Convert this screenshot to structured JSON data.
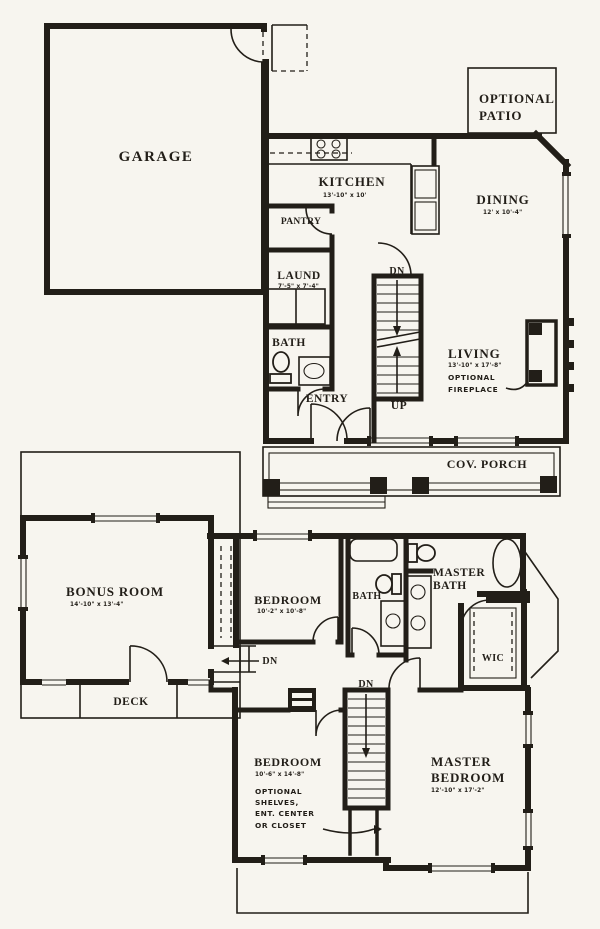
{
  "title": "Two-story house floor plan",
  "colors": {
    "paper": "#f7f5ef",
    "ink": "#221e18"
  },
  "first_floor": {
    "garage": "GARAGE",
    "kitchen": {
      "name": "KITCHEN",
      "dims": "13'-10\" x 10'"
    },
    "pantry": "PANTRY",
    "laundry": {
      "name": "LAUND",
      "dims": "7'-5\" x 7'-4\""
    },
    "bath": "BATH",
    "entry": "ENTRY",
    "dining": {
      "name": "DINING",
      "dims": "12' x 10'-4\""
    },
    "living": {
      "name": "LIVING",
      "dims": "13'-10\" x 17'-8\"",
      "note1": "OPTIONAL",
      "note2": "FIREPLACE"
    },
    "patio": {
      "line1": "OPTIONAL",
      "line2": "PATIO"
    },
    "porch": "COV. PORCH",
    "stairs": {
      "down": "DN",
      "up": "UP"
    }
  },
  "second_floor": {
    "bonus": {
      "name": "BONUS ROOM",
      "dims": "14'-10\" x 13'-4\""
    },
    "deck": "DECK",
    "bedroom2": {
      "name": "BEDROOM",
      "dims": "10'-2\" x 10'-8\""
    },
    "bath2": "BATH",
    "master_bath": {
      "line1": "MASTER",
      "line2": "BATH"
    },
    "wic": "WIC",
    "hall_steps": "DN",
    "stairs": {
      "down": "DN"
    },
    "bedroom3": {
      "name": "BEDROOM",
      "dims": "10'-6\" x 14'-8\"",
      "notes": [
        "OPTIONAL",
        "SHELVES,",
        "ENT. CENTER",
        "OR CLOSET"
      ]
    },
    "master_bedroom": {
      "line1": "MASTER",
      "line2": "BEDROOM",
      "dims": "12'-10\" x 17'-2\""
    }
  }
}
